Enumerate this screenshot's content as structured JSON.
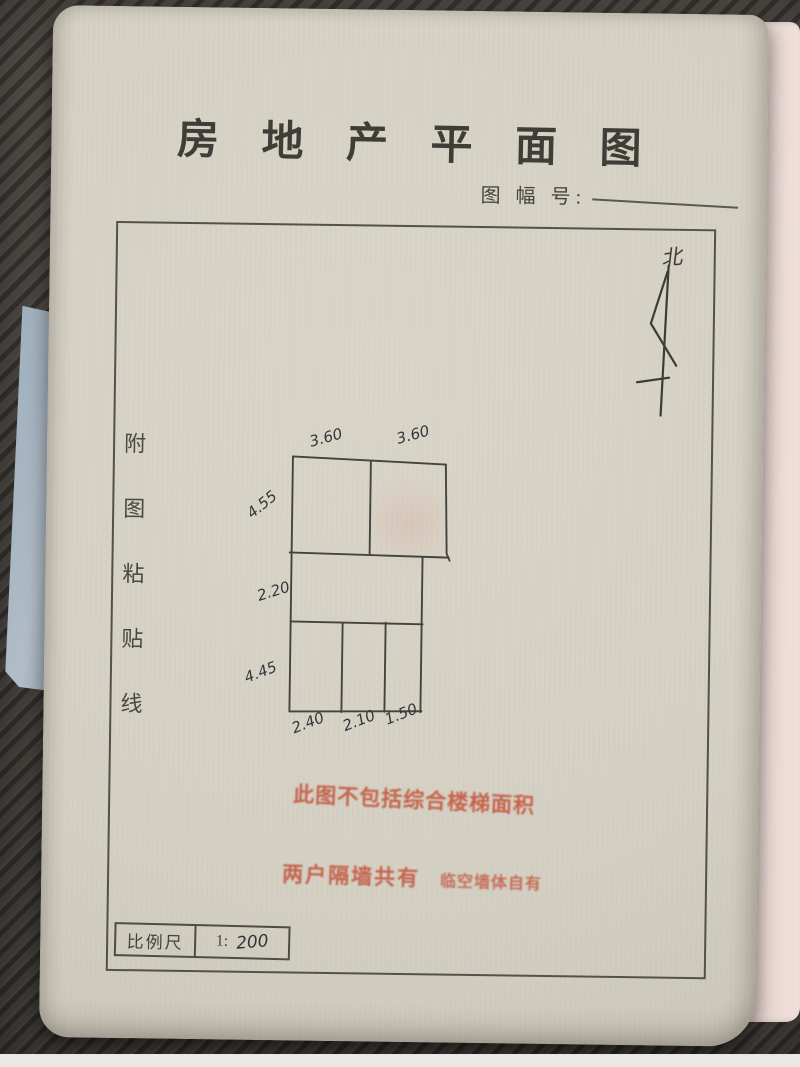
{
  "document": {
    "title": "房 地 产 平 面 图",
    "sheet_label": "图 幅 号:",
    "sheet_value": "",
    "north_label": "北",
    "paste_line_chars": [
      "附",
      "图",
      "粘",
      "贴",
      "线"
    ],
    "scale": {
      "label": "比例尺",
      "prefix": "1:",
      "value": "200"
    }
  },
  "plan": {
    "dims_top": [
      "3.60",
      "3.60"
    ],
    "dims_left": [
      "4.55",
      "2.20",
      "4.45"
    ],
    "dims_bottom": [
      "2.40",
      "2.10",
      "1.50"
    ]
  },
  "stamps": {
    "line1": "此图不包括综合楼梯面积",
    "line2_left": "两户隔墙共有",
    "line2_right": "临空墙体自有"
  },
  "colors": {
    "paper": "#d4d0c3",
    "desk": "#4b4843",
    "stamp_red": "#c35138",
    "ink": "#3f3d38",
    "pencil": "#45433f",
    "blue_note": "#a9b6c2",
    "pink_page": "#e9d7d3"
  }
}
